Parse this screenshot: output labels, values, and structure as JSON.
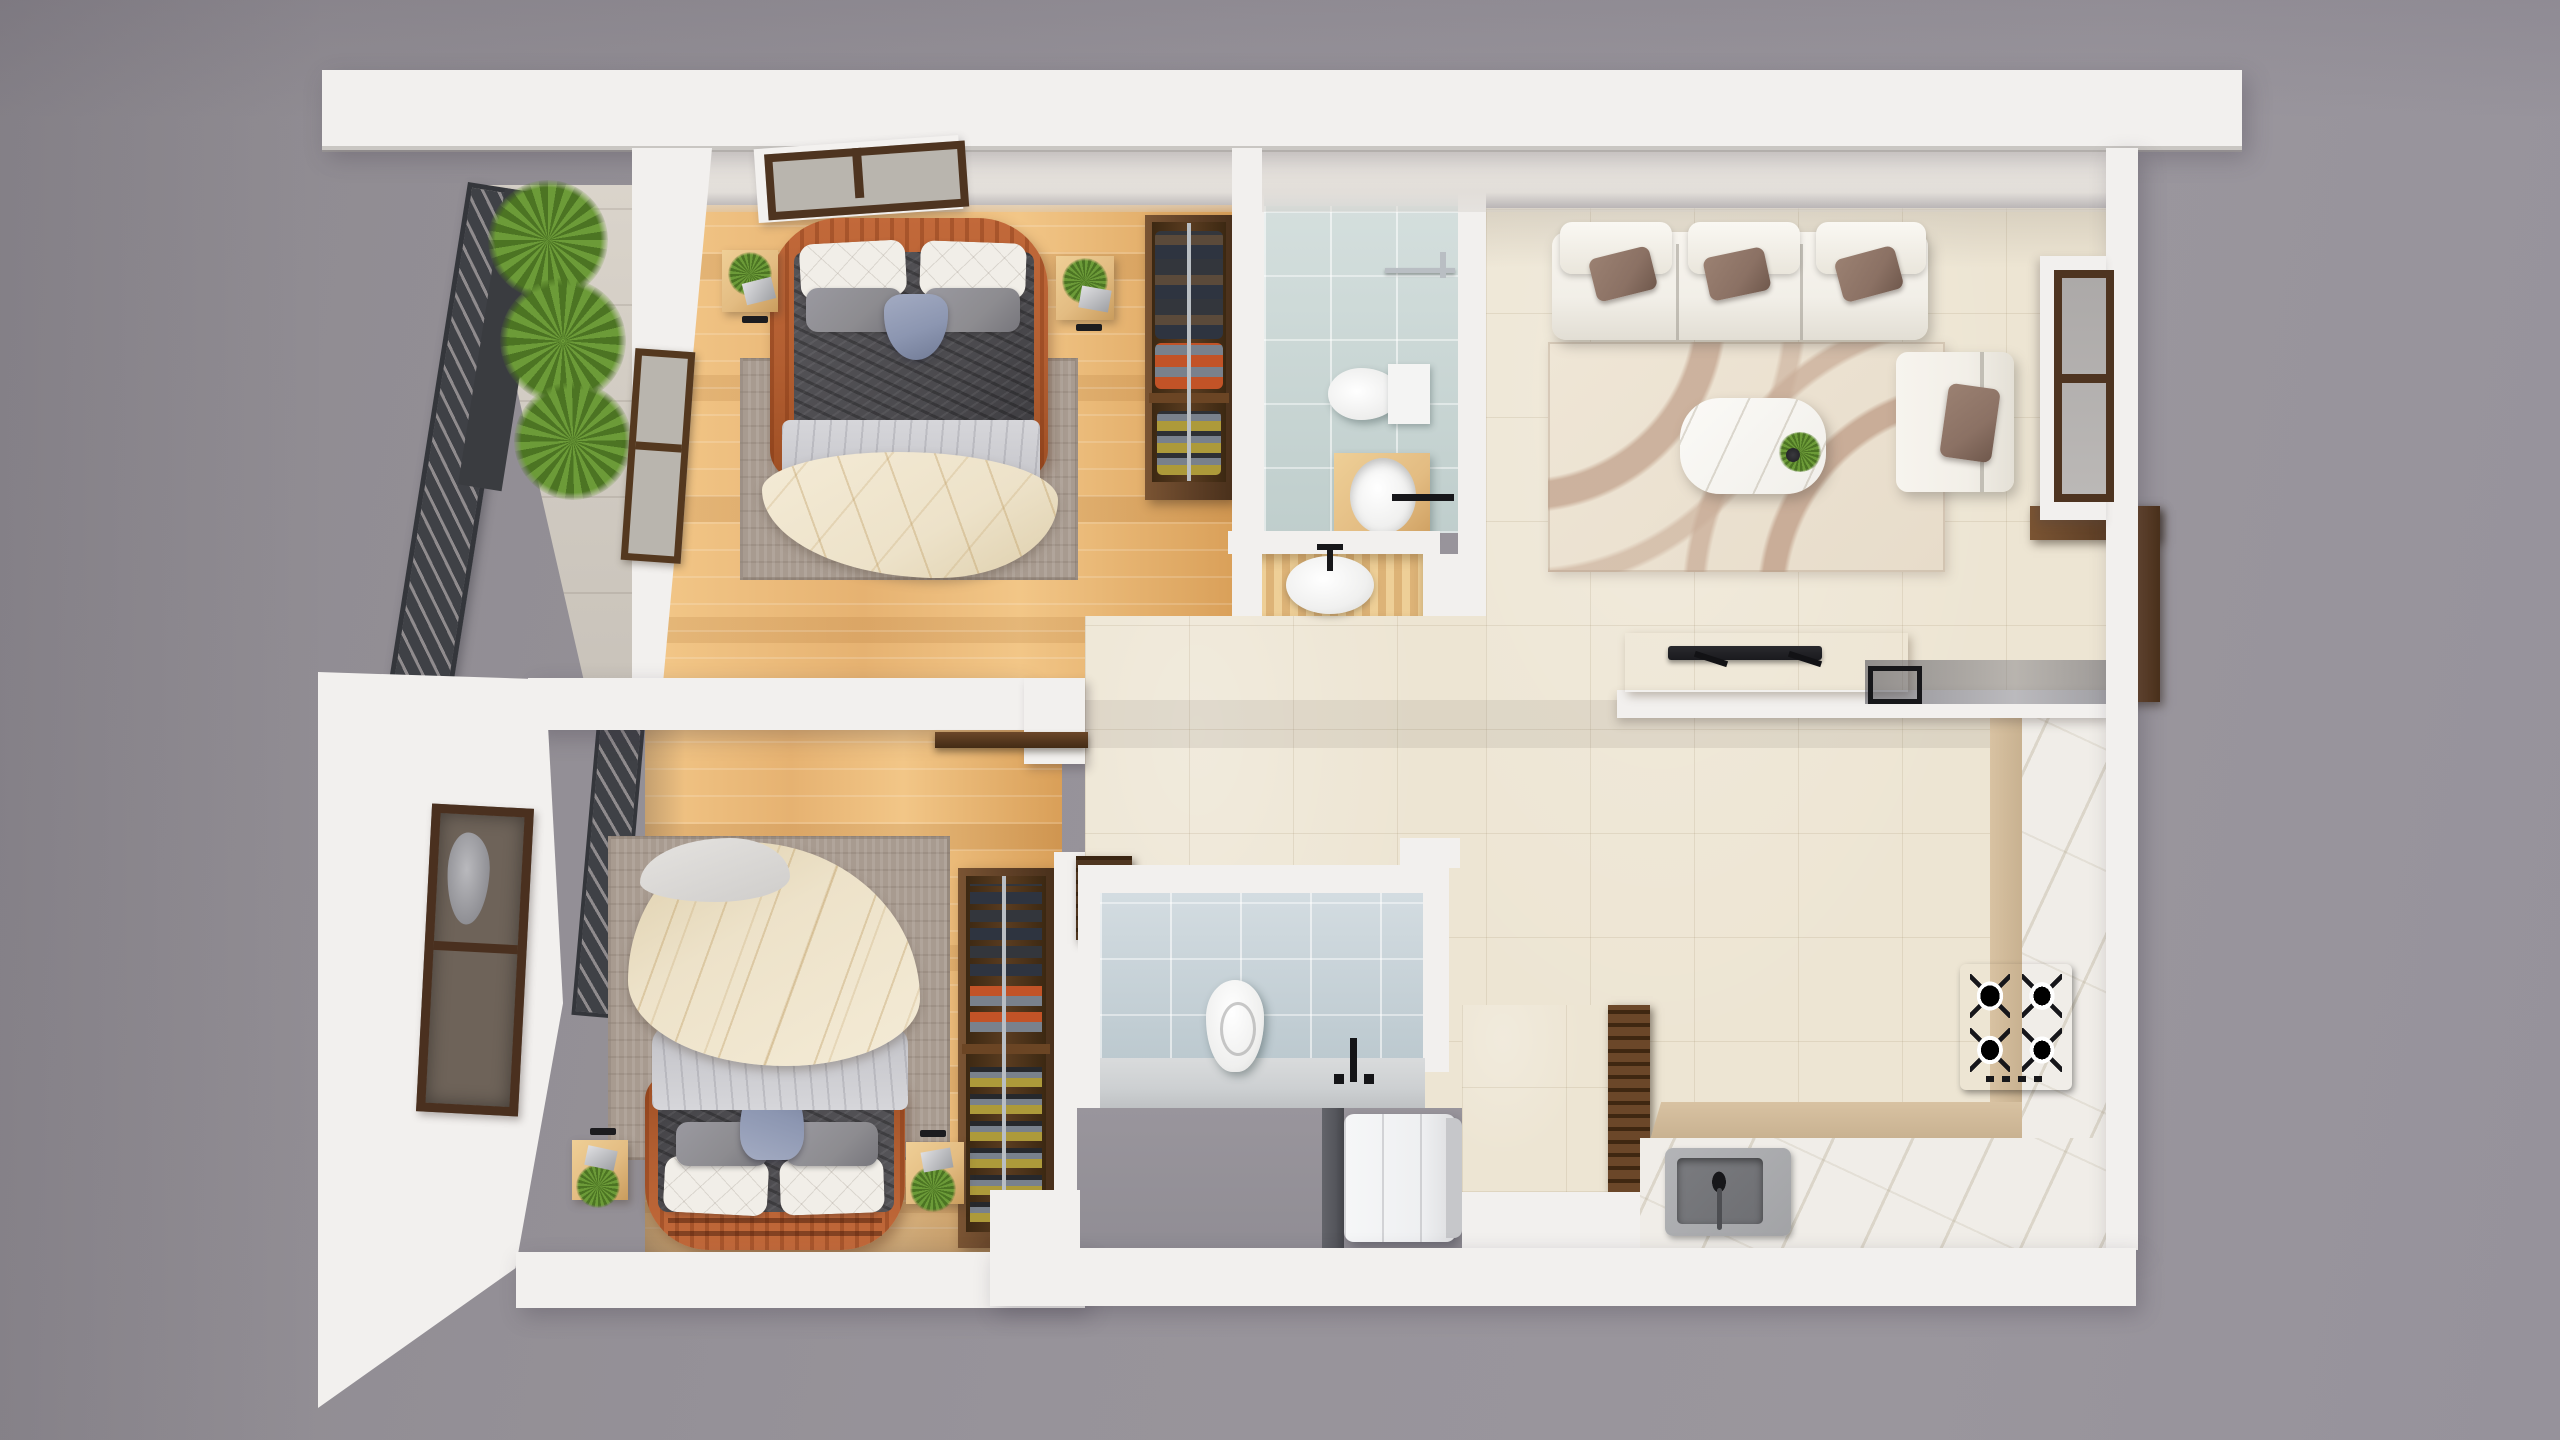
{
  "meta": {
    "title": "apartment-floor-plan-3d-render",
    "view": "top-down isometric render",
    "canvas": {
      "width": 2560,
      "height": 1440
    }
  },
  "palette": {
    "bg": "#97939A",
    "bg_left": "#8E8A90",
    "wall": "#F2F0EE",
    "wall_dim": "#E4E1DE",
    "wall_face": "#EAE6E1",
    "wood": "#E6B271",
    "wood_hi": "#F2C687",
    "wood_lo": "#D99F58",
    "tile": "#EDE5D3",
    "tile_line": "#D9CDB6",
    "bath_tile": "#CBD8D6",
    "bath_tile2": "#C9D4DA",
    "bath_counter": "#CDD0D2",
    "marble": "#F0EDE8",
    "marble_vein": "#BCB29E",
    "counter_tan": "#C8B190",
    "walnut": "#5E3F26",
    "walnut_dark": "#49301B",
    "walnut_light": "#7A5433",
    "oak": "#E3BC82",
    "orange": "#C2693A",
    "orange_dark": "#9E4F24",
    "duvet": "#4B4A4E",
    "duvet_dark": "#3A393D",
    "sheet": "#C8C8CD",
    "blanket": "#EDE2C9",
    "blanket_line": "#C8A96E",
    "pillow_white": "#F1EEE8",
    "pillow_gray": "#8D8C90",
    "pillow_taupe": "#8B7164",
    "pillow_blue": "#8C96B1",
    "sofa": "#F2EFE8",
    "rug_bed": "#A89B90",
    "rug_living": "#E7DCCA",
    "rug_wave": "#C9AD98",
    "green": "#6C9B38",
    "green_dark": "#4C7423",
    "louver": "#3F4146",
    "louver_slat": "#8F8B8D",
    "chrome": "#B9BEC3",
    "cooktop": "#47474C",
    "sink_outer": "#A2A3A6",
    "sink_inner": "#6E6F73",
    "washer": "#EEEFF1",
    "washer_side": "#C6C7CA",
    "door_panel": "#55565C",
    "glass": "#B9B5AE",
    "glass_dark": "#77695C",
    "glass_blue": "#AFC4C6",
    "entry_floor": "#908D94",
    "tv_black": "#1A1A1E",
    "clothes_navy": "#2E3440",
    "clothes_brown": "#5B4A3A",
    "clothes_dark": "#33363C",
    "clothes_orange": "#C25327",
    "clothes_gray": "#79818C",
    "clothes_olive": "#AD9A3A"
  },
  "scene": {
    "rooms": [
      {
        "name": "bedroom-top",
        "floor": "light-oak-plank",
        "objects": [
          "double-bed",
          "orange-rattan-headboard",
          "white-quilted-pillows",
          "gray-pillows",
          "blue-lumbar-pillow",
          "charcoal-duvet",
          "cream-leaf-blanket",
          "area-rug",
          "nightstand-left",
          "nightstand-right",
          "plant-pots",
          "wall-window",
          "balcony-door",
          "hanging-wardrobe"
        ]
      },
      {
        "name": "balcony",
        "objects": [
          "louvered-screen",
          "fern-planter",
          "stone-tile-floor"
        ]
      },
      {
        "name": "bathroom-top",
        "objects": [
          "rain-shower-head",
          "towel-bar",
          "wall-hung-toilet",
          "wood-vanity-oval-sink",
          "niche-vanity-oval-sink",
          "blue-glass-tile-floor"
        ]
      },
      {
        "name": "living-room",
        "objects": [
          "three-seat-sofa",
          "back-cushions",
          "taupe-throw-pillows",
          "wave-pattern-rug",
          "marble-coffee-table",
          "table-plant",
          "lounge-chair",
          "tv-console",
          "flat-tv",
          "entry-console-walnut",
          "side-window"
        ]
      },
      {
        "name": "kitchen",
        "objects": [
          "l-shaped-marble-counter",
          "tan-cabinet-face",
          "gas-cooktop",
          "kitchen-sink",
          "louvered-pantry-door"
        ]
      },
      {
        "name": "bedroom-bottom",
        "objects": [
          "double-bed",
          "orange-rattan-footboard",
          "white-quilted-pillows",
          "gray-pillows",
          "blue-lumbar-pillow",
          "charcoal-duvet",
          "cream-leaf-blanket",
          "area-rug",
          "nightstand-left",
          "nightstand-right",
          "shoe-wardrobe",
          "wall-window-west",
          "open-door-leaf"
        ]
      },
      {
        "name": "bathroom-bottom",
        "objects": [
          "wall-hung-toilet",
          "counter-with-black-faucet",
          "blue-tile-floor",
          "corner-wall-cabinet"
        ]
      },
      {
        "name": "entry-utility",
        "objects": [
          "washing-machine",
          "dark-door-panel",
          "gray-screed-floor",
          "tiled-niche"
        ]
      }
    ],
    "counts": {
      "cooktop_burners": 4,
      "sofa_seats": 3,
      "sofa_back_pillows": 3,
      "sofa_throw_pillows": 3,
      "balcony_ferns": 3,
      "wardrobe_sections": 2,
      "shoe_rack_sections": 2
    }
  }
}
